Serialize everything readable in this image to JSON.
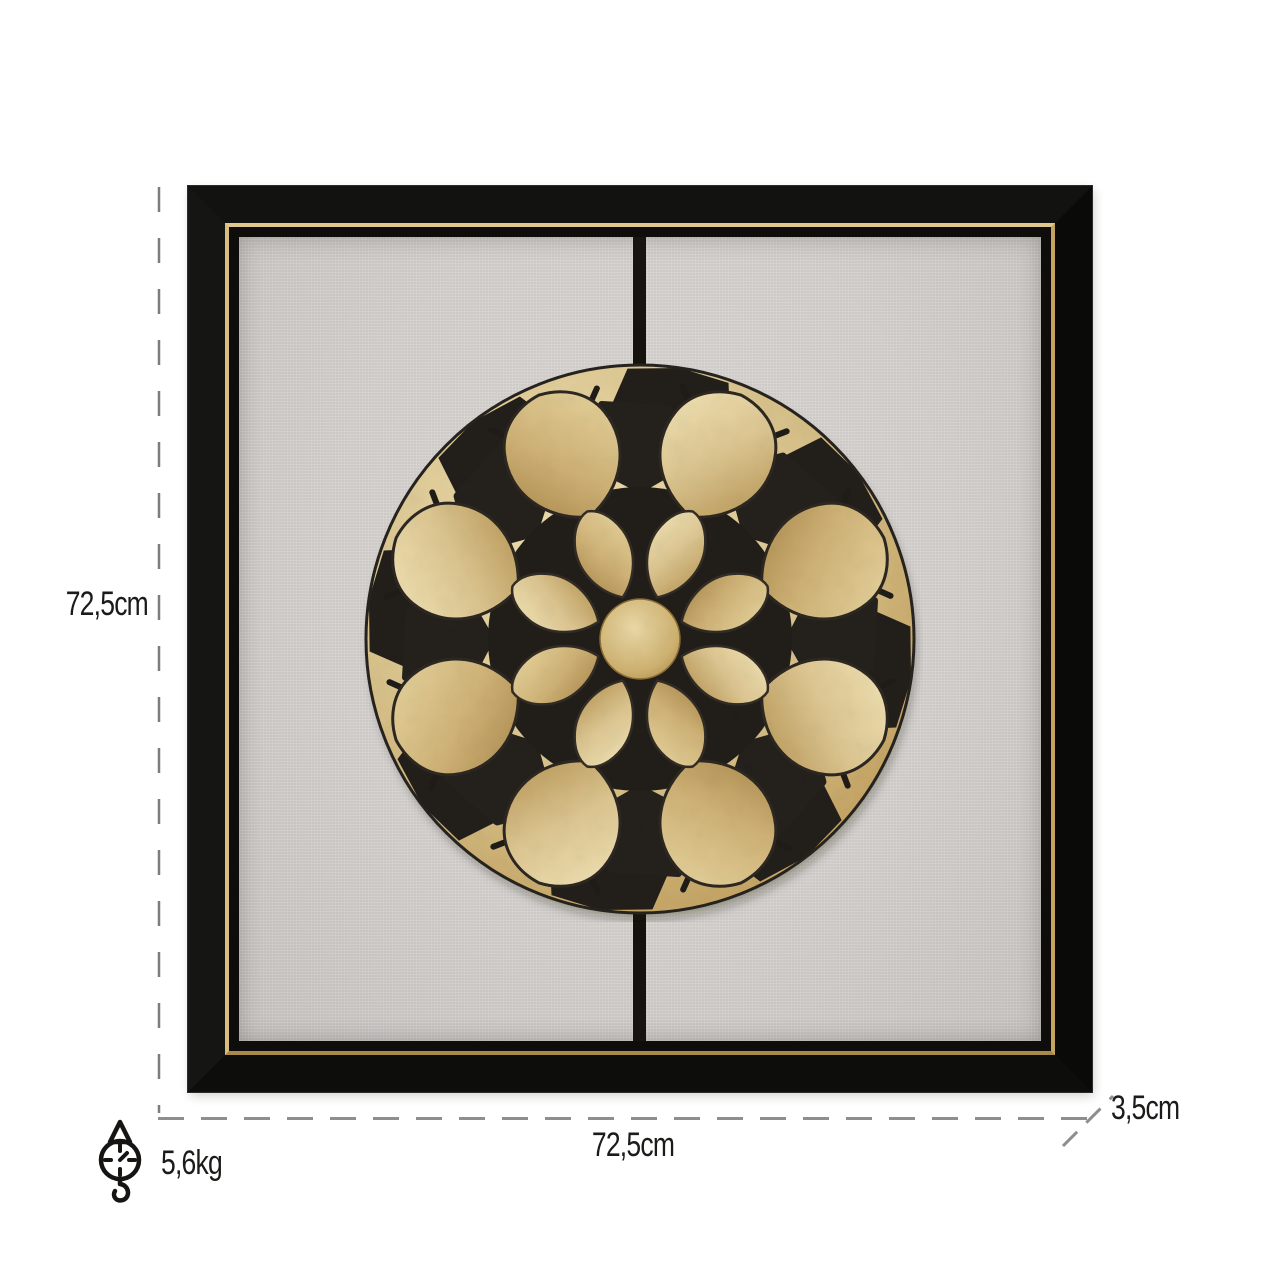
{
  "dimensions": {
    "height": "72,5cm",
    "width": "72,5cm",
    "depth": "3,5cm",
    "weight": "5,6kg"
  },
  "artwork": {
    "description": "square framed wall art, two-panel linen canvas with black and gold mosaic flower medallion",
    "frame_color": "#0d0c0b",
    "gold_trim_color": "#cfae66",
    "canvas_color": "#d5d2cf",
    "divider_color": "#14110d",
    "medallion_gold_light": "#efe1b2",
    "medallion_gold": "#d8c189",
    "medallion_gold_dark": "#a8874a",
    "medallion_black": "#221e1a"
  },
  "annotation": {
    "line_color": "#8c8c8c",
    "text_color": "#1c1b19"
  },
  "icons": {
    "weight_scale": "hanging-scale-icon"
  }
}
